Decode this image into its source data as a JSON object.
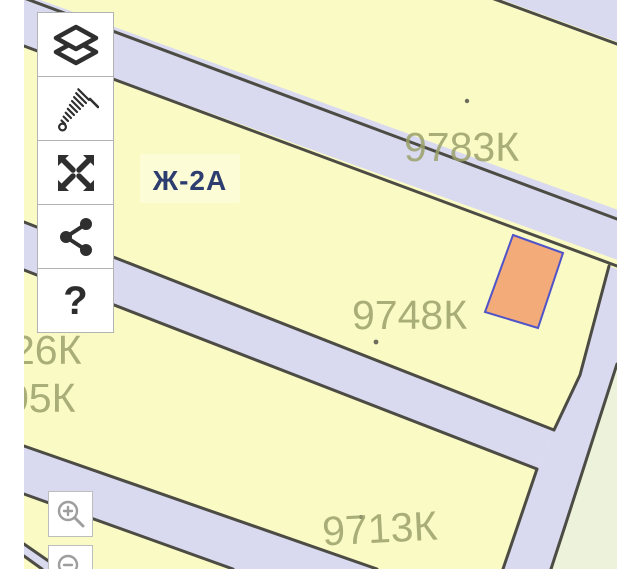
{
  "map": {
    "zone_label": "Ж-2А",
    "parcel_labels": [
      {
        "text": "9783К"
      },
      {
        "text": "9748К"
      },
      {
        "text": "9713К"
      },
      {
        "text": "26К"
      },
      {
        "text": "05К"
      }
    ],
    "colors": {
      "background": "#ffffff",
      "parcel": "#fafac5",
      "road": "#d9daf0",
      "boundary": "#4c4c44",
      "parcel_label": "#9aa06a",
      "zone_label": "#2e3d70",
      "zone_label_bg": "#fcfcd7",
      "highlight_fill": "#f2ab79",
      "highlight_stroke": "#5054c8",
      "green_zone": "#edf3da",
      "dot": "#6b6b5e"
    }
  },
  "toolbar": {
    "buttons": [
      {
        "id": "layers",
        "icon": "layers-icon"
      },
      {
        "id": "measure",
        "icon": "measure-icon"
      },
      {
        "id": "expand",
        "icon": "expand-arrows-icon"
      },
      {
        "id": "share",
        "icon": "share-icon"
      },
      {
        "id": "help",
        "icon": "question-icon",
        "glyph": "?"
      }
    ]
  },
  "zoom_controls": {
    "zoom_in_icon": "magnifier-plus-icon",
    "zoom_out_icon": "magnifier-minus-icon"
  }
}
